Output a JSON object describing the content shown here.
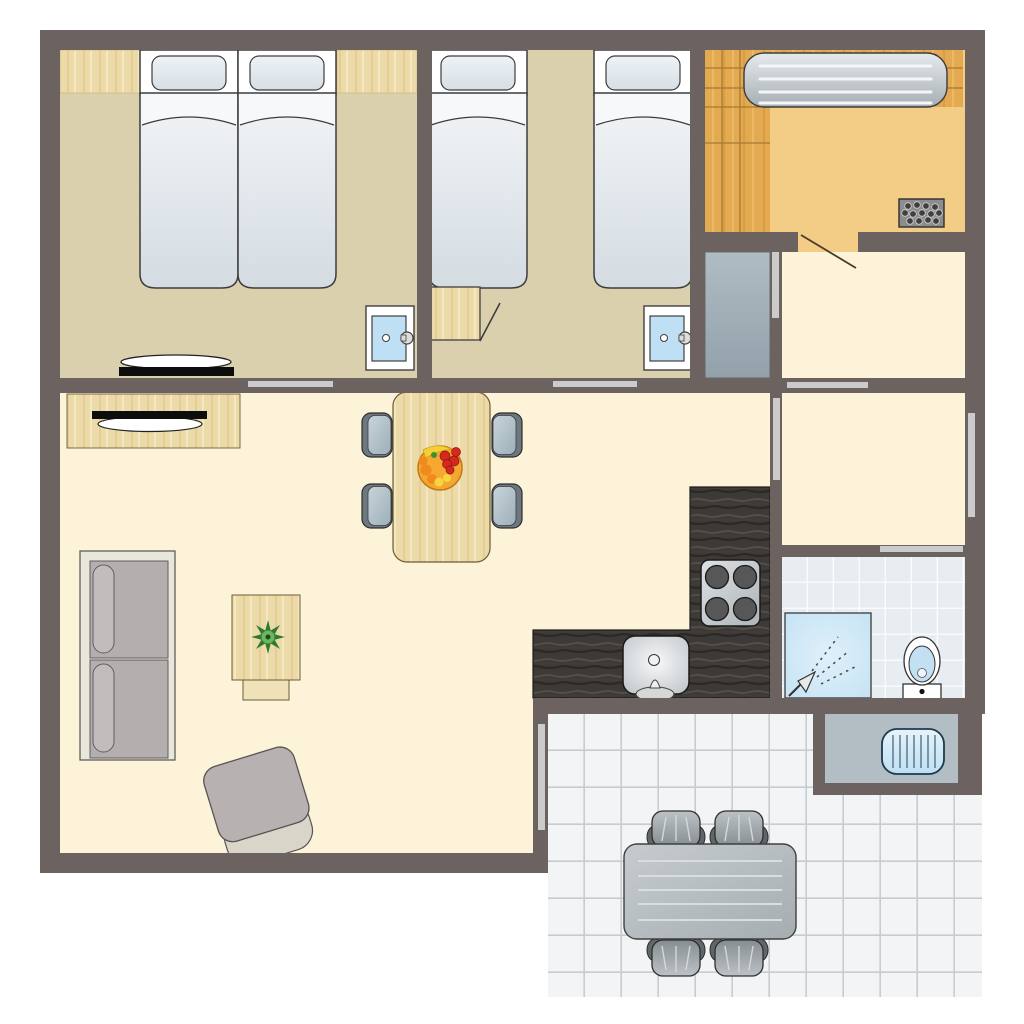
{
  "title": "holiday-bungalow-floor-plan",
  "colors": {
    "wall": "#6c6260",
    "bedroom_floor": "#dbd0ae",
    "living_floor": "#fdf3d8",
    "sauna_floor": "#f3cd86",
    "door_leaf": "#cbcbcb",
    "counter_dark": "#3d3936",
    "bath_tile": "#e8edf1",
    "terrace_tile": "#f2f4f6",
    "wood_light": "#ecdaa8",
    "wood_sauna": "#e4aa51",
    "water_blue": "#bfe0f4",
    "furniture_gray": "#b5aeae",
    "outdoor_gray": "#aab1b5"
  },
  "rooms": [
    {
      "name": "bedroom-double",
      "furniture": [
        "double-bed-two-mattresses",
        "wardrobe-top-left",
        "wardrobe-top-right",
        "washbasin",
        "wall-shelf",
        "sliding-door"
      ]
    },
    {
      "name": "bedroom-twin",
      "furniture": [
        "single-bed-left",
        "single-bed-right",
        "closet-open-door",
        "washbasin",
        "sliding-door"
      ]
    },
    {
      "name": "sauna",
      "furniture": [
        "wood-platform",
        "slatted-bench",
        "sauna-heater-stones",
        "swing-door"
      ]
    },
    {
      "name": "hallway-upper",
      "furniture": [
        "gray-closet",
        "closet-door"
      ]
    },
    {
      "name": "hallway-lower",
      "furniture": [
        "window-right-wall",
        "door-to-bathroom",
        "door-to-kitchen"
      ]
    },
    {
      "name": "bathroom",
      "furniture": [
        "shower-corner",
        "shower-head",
        "toilet"
      ]
    },
    {
      "name": "kitchen",
      "furniture": [
        "l-shaped-dark-counter",
        "stove-four-burners",
        "sink-with-faucet"
      ]
    },
    {
      "name": "living-room",
      "furniture": [
        "sideboard-with-tv",
        "dining-table",
        "four-dining-chairs",
        "fruit-bowl",
        "two-seat-sofa",
        "coffee-table",
        "potted-plant",
        "armchair",
        "terrace-door"
      ]
    },
    {
      "name": "outdoor-storage",
      "furniture": [
        "heater-unit"
      ]
    },
    {
      "name": "terrace",
      "furniture": [
        "outdoor-table",
        "four-outdoor-chairs",
        "tiled-floor"
      ]
    }
  ]
}
